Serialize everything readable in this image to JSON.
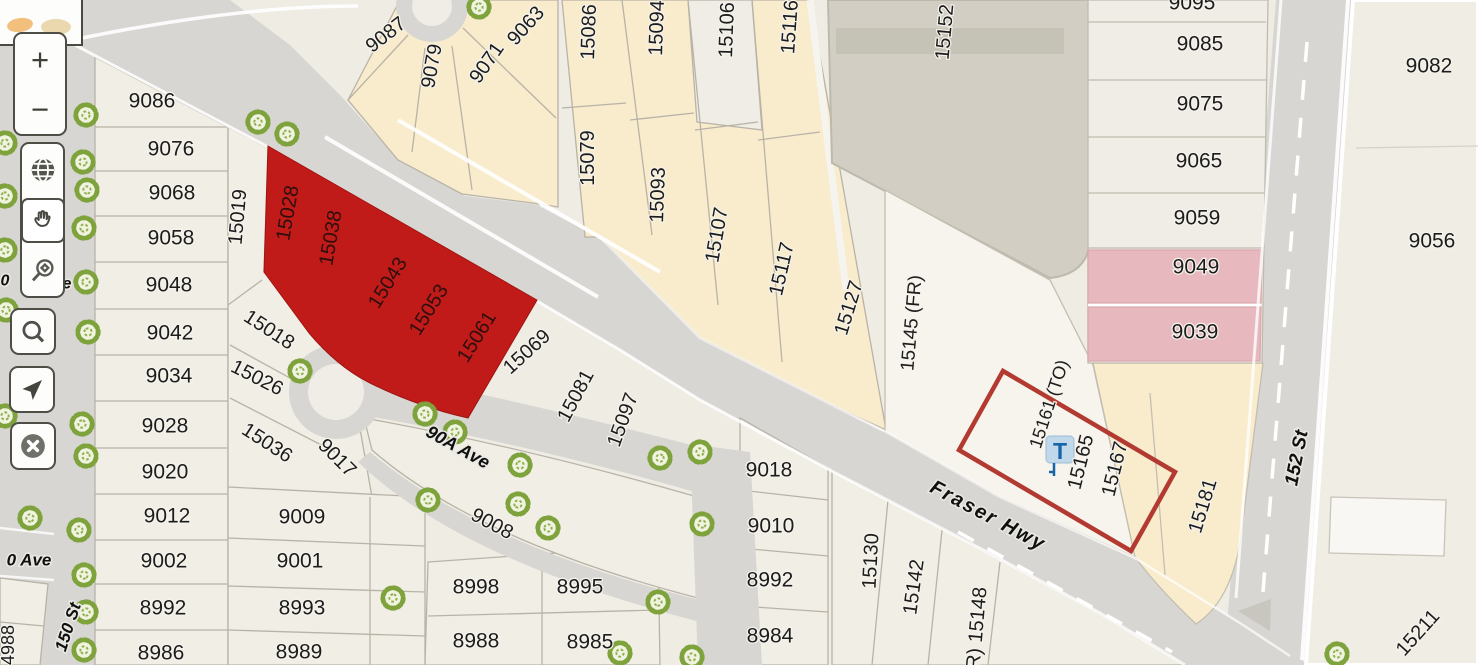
{
  "app": {
    "type": "parcel-map-viewer"
  },
  "colors": {
    "highlight_red": "#C01B18",
    "selection_outline": "#B23A31",
    "parcel_cream": "#F8ECCC",
    "parcel_pink": "#E7B9BE",
    "building_gray": "#D2CEC4",
    "road_gray": "#D7D6D2",
    "tree_green": "#7FA33C",
    "transit_blue": "#1565A8"
  },
  "toolbar": {
    "zoom_in_label": "+",
    "zoom_out_label": "−",
    "buttons": [
      "zoom-in",
      "zoom-out",
      "basemap-globe",
      "pan-hand",
      "zoom-box",
      "search",
      "locate",
      "close"
    ],
    "active_tool": "pan-hand"
  },
  "transit_marker": {
    "label": "T"
  },
  "map": {
    "selection": {
      "highlighted_parcels": [
        "15028",
        "15038",
        "15043",
        "15053",
        "15061"
      ],
      "outlined_parcels": [
        "15161 (TO)",
        "15165",
        "15167"
      ]
    },
    "street_labels": [
      {
        "t": "Fraser Hwy",
        "x": 988,
        "y": 516,
        "r": 28,
        "s": 20,
        "c": "st",
        "ls": 2
      },
      {
        "t": "152 St",
        "x": 1297,
        "y": 458,
        "r": -79,
        "s": 19,
        "c": "st"
      },
      {
        "t": "150 St",
        "x": 68,
        "y": 627,
        "r": -72,
        "s": 17,
        "c": "st"
      },
      {
        "t": "0 Ave",
        "x": 29,
        "y": 560,
        "s": 17,
        "c": "st"
      },
      {
        "t": "90A Ave",
        "x": 458,
        "y": 447,
        "r": 29,
        "s": 18,
        "c": "st"
      },
      {
        "t": "0",
        "x": 5,
        "y": 281,
        "s": 16,
        "c": "st"
      },
      {
        "t": "e",
        "x": 67,
        "y": 284,
        "s": 16,
        "c": "st"
      }
    ],
    "parcel_labels": [
      {
        "t": "9086",
        "x": 152,
        "y": 101
      },
      {
        "t": "9076",
        "x": 171,
        "y": 149
      },
      {
        "t": "9068",
        "x": 172,
        "y": 193
      },
      {
        "t": "9058",
        "x": 171,
        "y": 238
      },
      {
        "t": "9048",
        "x": 169,
        "y": 285
      },
      {
        "t": "9042",
        "x": 170,
        "y": 333
      },
      {
        "t": "9034",
        "x": 169,
        "y": 376
      },
      {
        "t": "9028",
        "x": 165,
        "y": 426
      },
      {
        "t": "9020",
        "x": 165,
        "y": 472
      },
      {
        "t": "9012",
        "x": 167,
        "y": 516
      },
      {
        "t": "9002",
        "x": 164,
        "y": 561
      },
      {
        "t": "8992",
        "x": 163,
        "y": 608
      },
      {
        "t": "8986",
        "x": 161,
        "y": 653
      },
      {
        "t": "15019",
        "x": 238,
        "y": 217,
        "r": -85,
        "s": 20
      },
      {
        "t": "15018",
        "x": 269,
        "y": 330,
        "r": 33,
        "s": 20
      },
      {
        "t": "15026",
        "x": 257,
        "y": 378,
        "r": 27,
        "s": 20
      },
      {
        "t": "15036",
        "x": 267,
        "y": 443,
        "r": 33,
        "s": 20
      },
      {
        "t": "9017",
        "x": 337,
        "y": 458,
        "r": 45,
        "s": 20
      },
      {
        "t": "9009",
        "x": 302,
        "y": 517
      },
      {
        "t": "9001",
        "x": 300,
        "y": 561
      },
      {
        "t": "8993",
        "x": 302,
        "y": 608
      },
      {
        "t": "8989",
        "x": 299,
        "y": 652
      },
      {
        "t": "15028",
        "x": 288,
        "y": 213,
        "r": -80,
        "s": 20,
        "c": "pr"
      },
      {
        "t": "15038",
        "x": 331,
        "y": 238,
        "r": -80,
        "s": 20,
        "c": "pr"
      },
      {
        "t": "15043",
        "x": 388,
        "y": 283,
        "r": -58,
        "s": 20,
        "c": "pr"
      },
      {
        "t": "15053",
        "x": 429,
        "y": 310,
        "r": -58,
        "s": 20,
        "c": "pr"
      },
      {
        "t": "15061",
        "x": 477,
        "y": 337,
        "r": -58,
        "s": 20,
        "c": "pr"
      },
      {
        "t": "15069",
        "x": 527,
        "y": 352,
        "r": -42,
        "s": 20
      },
      {
        "t": "15081",
        "x": 576,
        "y": 396,
        "r": -62,
        "s": 20
      },
      {
        "t": "15097",
        "x": 623,
        "y": 420,
        "r": -70,
        "s": 20
      },
      {
        "t": "9008",
        "x": 492,
        "y": 524,
        "r": 28,
        "s": 20
      },
      {
        "t": "8998",
        "x": 476,
        "y": 587
      },
      {
        "t": "8995",
        "x": 580,
        "y": 587
      },
      {
        "t": "8988",
        "x": 476,
        "y": 641
      },
      {
        "t": "8985",
        "x": 590,
        "y": 642
      },
      {
        "t": "9087",
        "x": 386,
        "y": 35,
        "r": -38,
        "s": 20
      },
      {
        "t": "9079",
        "x": 432,
        "y": 66,
        "r": -80,
        "s": 20
      },
      {
        "t": "9071",
        "x": 487,
        "y": 63,
        "r": -55,
        "s": 20
      },
      {
        "t": "9063",
        "x": 526,
        "y": 26,
        "r": -48,
        "s": 20
      },
      {
        "t": "15086",
        "x": 589,
        "y": 32,
        "r": -88,
        "s": 20
      },
      {
        "t": "15079",
        "x": 588,
        "y": 158,
        "r": -90,
        "s": 20
      },
      {
        "t": "15094",
        "x": 657,
        "y": 28,
        "r": -88,
        "s": 20
      },
      {
        "t": "15093",
        "x": 658,
        "y": 195,
        "r": -88,
        "s": 20
      },
      {
        "t": "15106",
        "x": 727,
        "y": 30,
        "r": -88,
        "s": 20
      },
      {
        "t": "15107",
        "x": 717,
        "y": 235,
        "r": -80,
        "s": 20
      },
      {
        "t": "15116",
        "x": 790,
        "y": 27,
        "r": -86,
        "s": 20
      },
      {
        "t": "15117",
        "x": 782,
        "y": 269,
        "r": -77,
        "s": 20
      },
      {
        "t": "15127",
        "x": 849,
        "y": 308,
        "r": -73,
        "s": 20
      },
      {
        "t": "15152",
        "x": 945,
        "y": 32,
        "r": -85,
        "s": 20
      },
      {
        "t": "15145 (FR)",
        "x": 912,
        "y": 323,
        "r": -85,
        "s": 19
      },
      {
        "t": "9095",
        "x": 1192,
        "y": 3
      },
      {
        "t": "9085",
        "x": 1200,
        "y": 44
      },
      {
        "t": "9075",
        "x": 1200,
        "y": 104
      },
      {
        "t": "9065",
        "x": 1199,
        "y": 161
      },
      {
        "t": "9059",
        "x": 1197,
        "y": 218
      },
      {
        "t": "9049",
        "x": 1196,
        "y": 267
      },
      {
        "t": "9039",
        "x": 1195,
        "y": 332
      },
      {
        "t": "9082",
        "x": 1429,
        "y": 66
      },
      {
        "t": "9056",
        "x": 1432,
        "y": 241
      },
      {
        "t": "15161 (TO)",
        "x": 1049,
        "y": 404,
        "r": -72,
        "s": 18
      },
      {
        "t": "15165",
        "x": 1081,
        "y": 462,
        "r": -76,
        "s": 20
      },
      {
        "t": "15167",
        "x": 1115,
        "y": 469,
        "r": -76,
        "s": 20
      },
      {
        "t": "15181",
        "x": 1203,
        "y": 506,
        "r": -73,
        "s": 20
      },
      {
        "t": "15211",
        "x": 1418,
        "y": 633,
        "r": -48,
        "s": 20
      },
      {
        "t": "9018",
        "x": 769,
        "y": 470
      },
      {
        "t": "9010",
        "x": 771,
        "y": 526
      },
      {
        "t": "8992",
        "x": 770,
        "y": 580
      },
      {
        "t": "8984",
        "x": 770,
        "y": 636
      },
      {
        "t": "15130",
        "x": 871,
        "y": 561,
        "r": -87,
        "s": 20
      },
      {
        "t": "15142",
        "x": 914,
        "y": 587,
        "r": -82,
        "s": 20
      },
      {
        "t": "R) 15148",
        "x": 977,
        "y": 628,
        "r": -85,
        "s": 20
      },
      {
        "t": "4988",
        "x": 8,
        "y": 645,
        "r": -90,
        "s": 18
      }
    ]
  }
}
